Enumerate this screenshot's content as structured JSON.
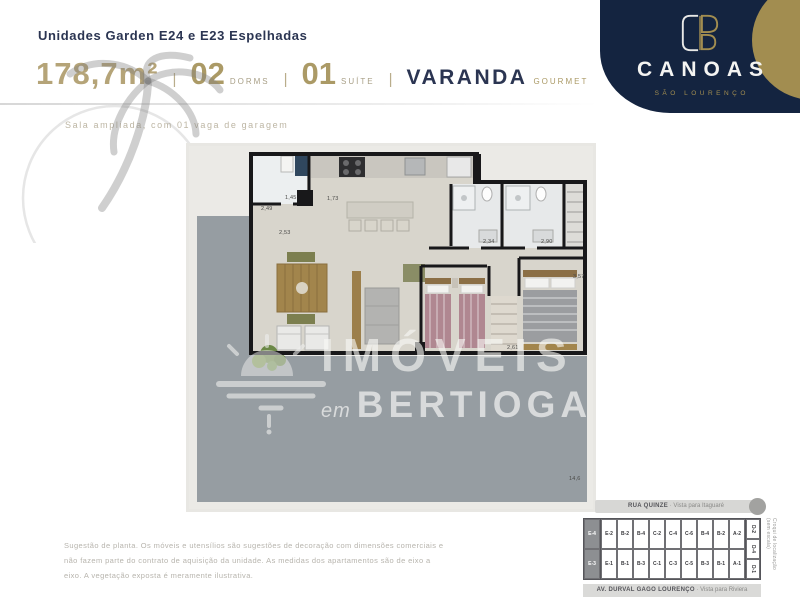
{
  "header": {
    "title": "Unidades Garden E24 e E23 Espelhadas",
    "area": "178,7m²",
    "separator": "|",
    "specs": [
      {
        "value": "02",
        "label": "DORMS"
      },
      {
        "value": "01",
        "label": "SUÍTE"
      }
    ],
    "varanda": "VARANDA",
    "varanda_label": "GOURMET",
    "subtitle": "Sala ampliada, com 01 vaga de garagem"
  },
  "brand": {
    "name": "CANOAS",
    "location": "SÃO LOURENÇO",
    "navy": "#142440",
    "gold": "#a28d50"
  },
  "watermark": {
    "line1": "IMÓVEIS",
    "line2_prefix": "em",
    "line2": "BERTIOGA"
  },
  "floorplan": {
    "deck_color": "#969da2",
    "floor_color": "#d8d5cc",
    "dimensions": [
      {
        "t": "1,45",
        "x": 96,
        "y": 49
      },
      {
        "t": "2,49",
        "x": 72,
        "y": 60
      },
      {
        "t": "1,73",
        "x": 138,
        "y": 50
      },
      {
        "t": "2,53",
        "x": 90,
        "y": 84
      },
      {
        "t": "2,34",
        "x": 294,
        "y": 93
      },
      {
        "t": "2,90",
        "x": 352,
        "y": 93
      },
      {
        "t": "2,61",
        "x": 318,
        "y": 199
      },
      {
        "t": "3,57",
        "x": 384,
        "y": 128
      },
      {
        "t": "14,6",
        "x": 380,
        "y": 330
      }
    ]
  },
  "keyplan": {
    "top_street": "RUA QUINZE",
    "top_view": " · Vista para Itaguaré",
    "bottom_street": "AV. DURVAL GAGO LOURENÇO",
    "bottom_view": " · Vista para Riviera",
    "side_note": "Croqui de localização (sem escala)",
    "left_col": [
      "E-4",
      "E-3"
    ],
    "top_row": [
      "E-2",
      "B-2",
      "B-4",
      "C-2",
      "C-4",
      "C-6",
      "B-4",
      "B-2",
      "A-2"
    ],
    "bottom_row": [
      "E-1",
      "B-1",
      "B-3",
      "C-1",
      "C-3",
      "C-5",
      "B-3",
      "B-1",
      "A-1"
    ],
    "right_col": [
      "D-2",
      "D-4",
      "D-1"
    ]
  },
  "footer": {
    "lines": [
      "Sugestão de planta. Os móveis e utensílios são sugestões de decoração com dimensões comerciais e",
      "não fazem parte do contrato de aquisição da unidade. As medidas dos apartamentos são de eixo a",
      "eixo. A vegetação exposta é meramente ilustrativa."
    ]
  }
}
